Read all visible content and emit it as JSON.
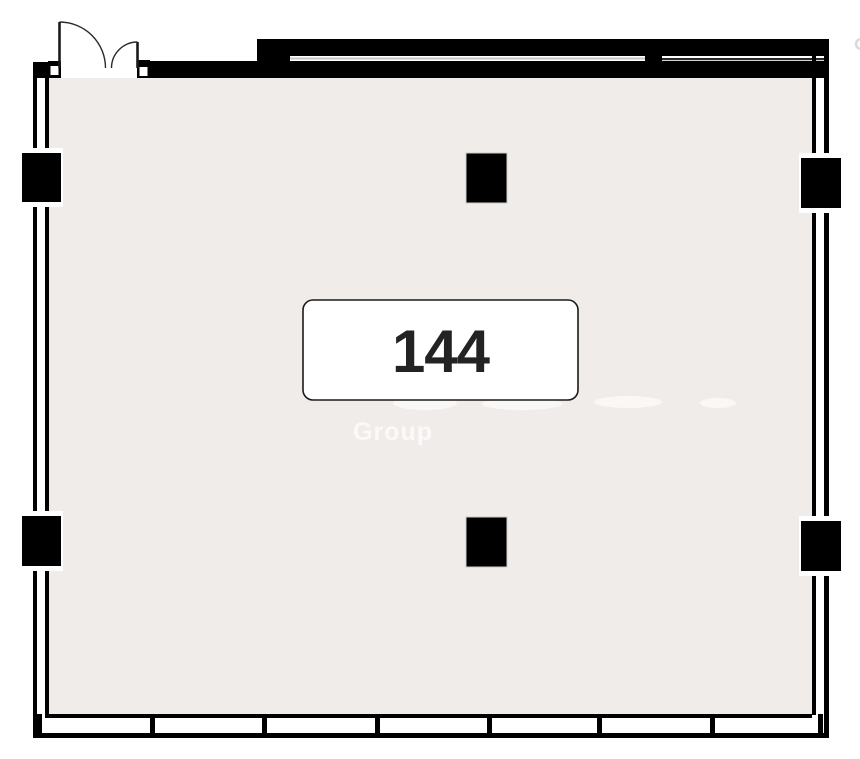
{
  "room": {
    "number": "144"
  },
  "watermark": {
    "text": "Group"
  },
  "colors": {
    "floor": "#f0ece9",
    "wall": "#000000",
    "label_fill": "#ffffff",
    "label_border": "#1a1a1a",
    "number_text": "#232323",
    "watermark_text": "#ffffff"
  }
}
